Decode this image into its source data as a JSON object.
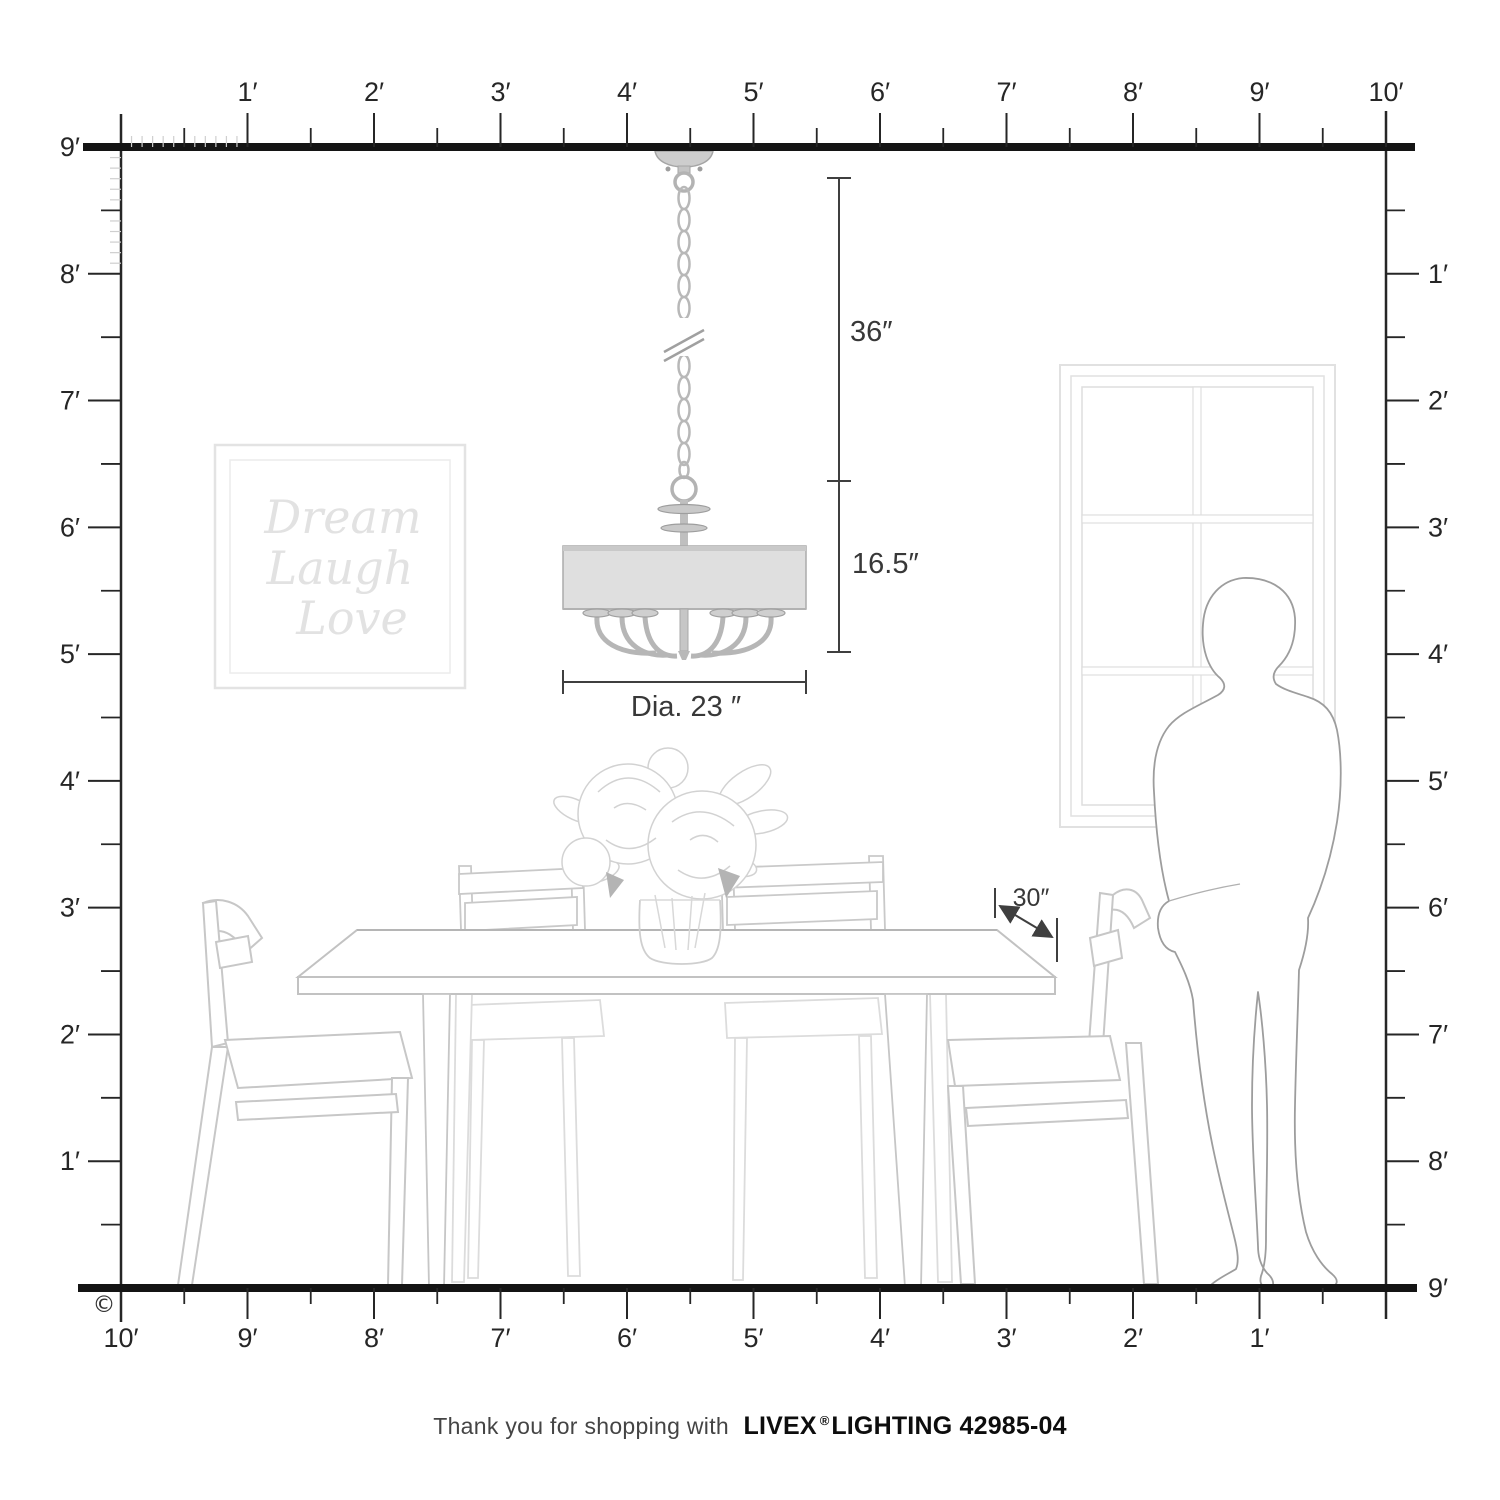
{
  "meta": {
    "copyright": "©"
  },
  "rulers": {
    "top": {
      "labels": [
        "1′",
        "2′",
        "3′",
        "4′",
        "5′",
        "6′",
        "7′",
        "8′",
        "9′",
        "10′"
      ]
    },
    "left": {
      "labels": [
        "9′",
        "8′",
        "7′",
        "6′",
        "5′",
        "4′",
        "3′",
        "2′",
        "1′"
      ]
    },
    "right": {
      "labels": [
        "1′",
        "2′",
        "3′",
        "4′",
        "5′",
        "6′",
        "7′",
        "8′",
        "9′"
      ]
    },
    "bottom": {
      "labels": [
        "10′",
        "9′",
        "8′",
        "7′",
        "6′",
        "5′",
        "4′",
        "3′",
        "2′",
        "1′"
      ]
    }
  },
  "dimensions": {
    "chain_drop": "36″",
    "fixture_height": "16.5″",
    "diameter": "Dia. 23 ″",
    "table_clearance": "30″"
  },
  "wall_art": {
    "line1": "Dream",
    "line2": "Laugh",
    "line3": "Love"
  },
  "footer": {
    "prefix": "Thank you for shopping with",
    "brand": "LIVEX",
    "registered": "®",
    "suffix": "LIGHTING 42985-04"
  },
  "colors": {
    "ink": "#262626",
    "frame_line": "#141414",
    "dimension": "#3f3f3f",
    "furniture_line": "#c6c6c6",
    "furniture_light": "#dcdcdc",
    "person_line": "#9d9d9d",
    "metal": "#b5b5b5",
    "shade_fill": "#dfdfdf",
    "art_line": "#e3e3e3",
    "inch_tick": "#cfcfcf"
  }
}
